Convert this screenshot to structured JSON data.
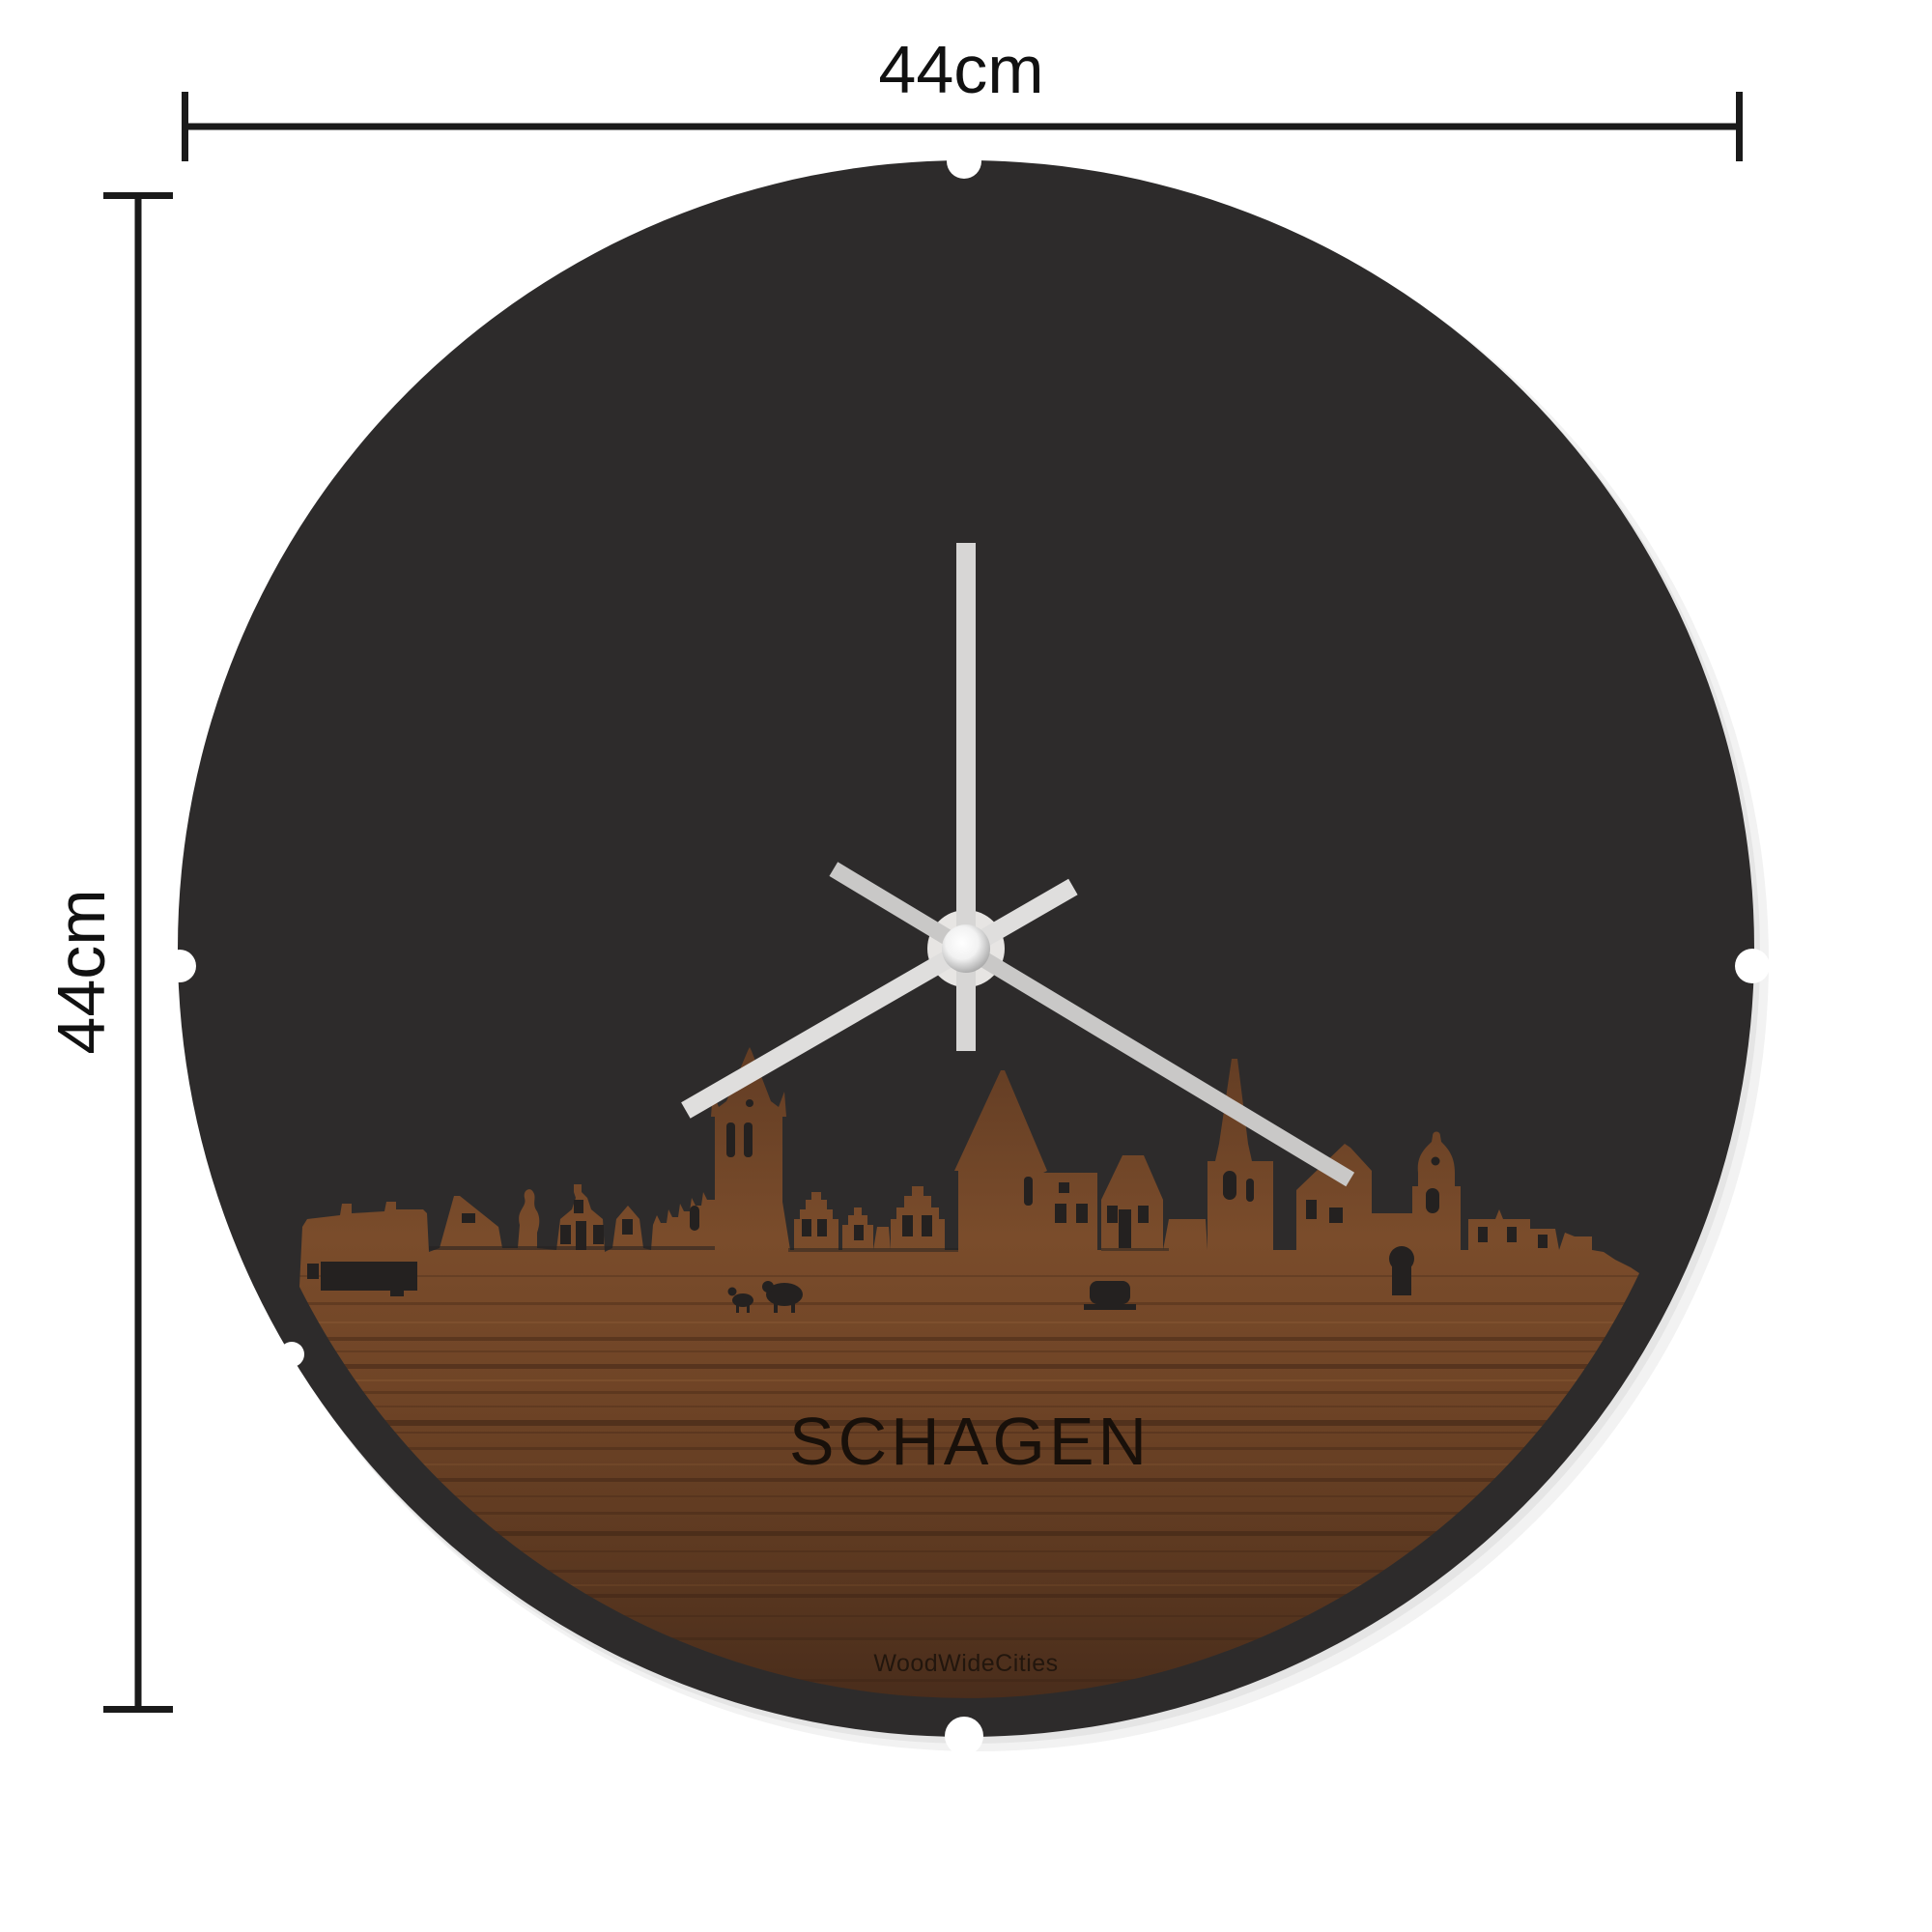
{
  "page": {
    "background": "#ffffff"
  },
  "dimensions": {
    "width_label": "44cm",
    "height_label": "44cm",
    "line_color": "#1a1a1a"
  },
  "clock": {
    "city_label": "SCHAGEN",
    "watermark": "WoodWideCities",
    "face_color": "#2d2b2b",
    "notch_color": "#ffffff",
    "hub_plate_color": "#e7e5e3",
    "wood": {
      "stops": [
        "#633d24",
        "#7a4c2b",
        "#6f4426",
        "#5b3820",
        "#482c1b"
      ],
      "grain_dark": "#2e1a10",
      "grain_light": "#c08a52",
      "cutout_color": "#242120",
      "label_color": "#18100a"
    },
    "hands": {
      "minute": {
        "transform": "rotate(0 1000 982)",
        "color": "#d7d6d5"
      },
      "hour": {
        "transform": "rotate(240 1000 982)",
        "color": "#dfdedd"
      },
      "second": {
        "transform": "rotate(121 1000 982)",
        "color": "#c9c8c7"
      }
    }
  }
}
